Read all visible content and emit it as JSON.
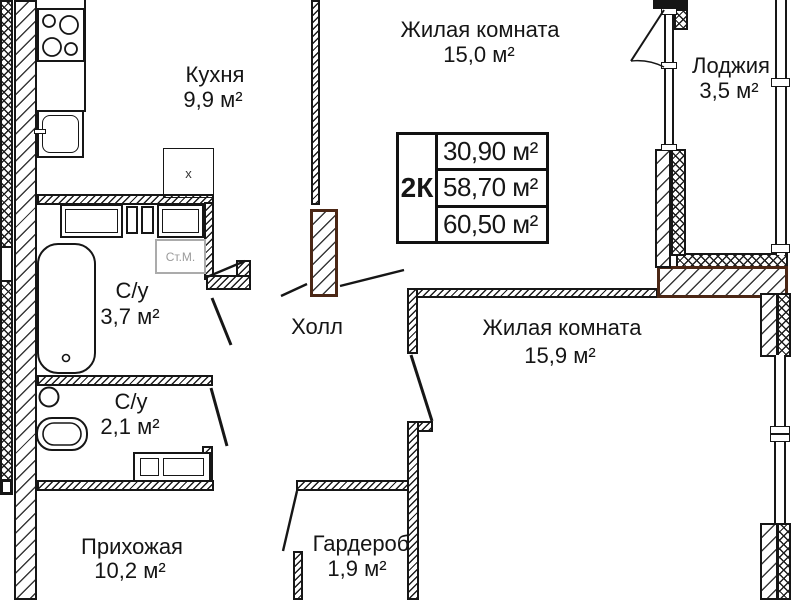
{
  "colors": {
    "line": "#161616",
    "wall_accent_brown": "#4b2715",
    "appliance_gray": "#9b9b9b"
  },
  "info_box": {
    "type_label": "2К",
    "area_rows": [
      "30,90 м²",
      "58,70 м²",
      "60,50 м²"
    ]
  },
  "rooms": {
    "kitchen": {
      "name": "Кухня",
      "area": "9,9 м²"
    },
    "living_room_top": {
      "name": "Жилая комната",
      "area": "15,0 м²"
    },
    "loggia": {
      "name": "Лоджия",
      "area": "3,5 м²"
    },
    "bathroom": {
      "name": "С/у",
      "area": "3,7 м²"
    },
    "toilet": {
      "name": "С/у",
      "area": "2,1 м²"
    },
    "hall": {
      "name": "Холл"
    },
    "living_room_right": {
      "name": "Жилая комната",
      "area": "15,9 м²"
    },
    "entry_hall": {
      "name": "Прихожая",
      "area": "10,2 м²"
    },
    "wardrobe": {
      "name": "Гардероб",
      "area": "1,9 м²"
    }
  },
  "appliances": {
    "washing_machine_label": "Ст.М.",
    "vent_label": "x"
  }
}
